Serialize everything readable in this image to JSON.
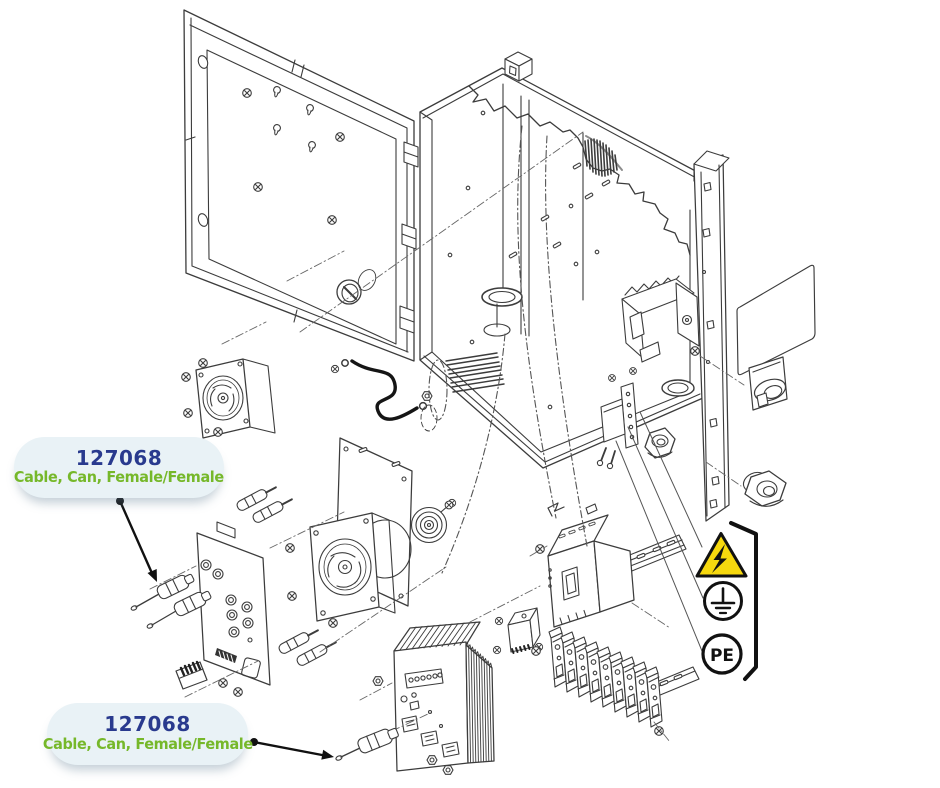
{
  "page": {
    "background": "#ffffff"
  },
  "colors": {
    "part_number_blue": "#293a8e",
    "description_green": "#76b82a",
    "bubble_bg": "#e9f2f6",
    "bubble_shadow": "rgba(100,130,150,0.38)",
    "hazard_yellow": "#f6d80e",
    "ink": "#3c3c3c"
  },
  "callouts": [
    {
      "part_number": "127068",
      "description": "Cable, Can, Female/Female"
    },
    {
      "part_number": "127068",
      "description": "Cable, Can, Female/Female"
    }
  ],
  "safety_symbols": {
    "hazard_icon": "high-voltage-warning-triangle",
    "earth_icon": "protective-earth-ground",
    "pe_label": "PE"
  }
}
